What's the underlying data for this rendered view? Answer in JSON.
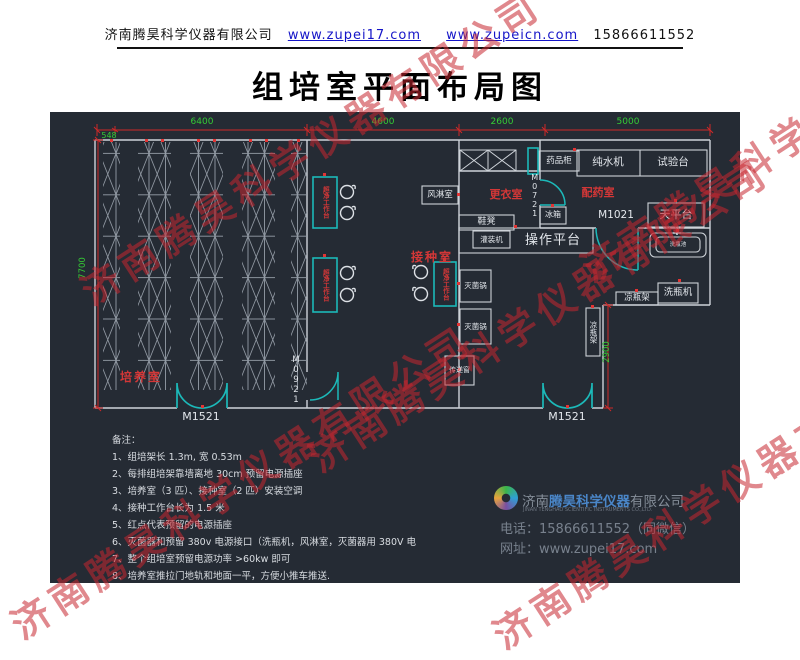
{
  "header": {
    "company": "济南腾昊科学仪器有限公司",
    "url1": "www.zupei17.com",
    "url2": "www.zupeicn.com",
    "phone": "15866611552"
  },
  "title": "组培室平面布局图",
  "watermark": {
    "text": "济南腾昊科学仪器有限公司"
  },
  "plan": {
    "dims": {
      "d548": "548",
      "d6400": "6400",
      "d4600": "4600",
      "d2600": "2600",
      "d5000": "5000",
      "d7700": "7700",
      "d2900": "2900"
    },
    "rooms": {
      "culture": "培养室",
      "inoculation": "接种室",
      "changing": "更衣室",
      "dispensing": "配药室"
    },
    "doors": {
      "m1521": "M1521",
      "m0921": "M0921",
      "m0721": "M0721",
      "m1021": "M1021"
    },
    "fixtures": {
      "air_shower": "风淋室",
      "medicine_cabinet": "药品柜",
      "water_purifier": "纯水机",
      "test_bench": "试验台",
      "fridge": "冰箱",
      "balance_table": "天平台",
      "sink": "洗瓶池",
      "shoe_bench": "鞋凳",
      "filling_machine": "灌装机",
      "operation_platform": "操作平台",
      "sterilizer": "灭菌锅",
      "transfer_window": "传递窗",
      "bottle_cool_rack": "凉瓶架",
      "bottle_washer": "洗瓶机",
      "clean_bench": "超净工作台"
    }
  },
  "notes": {
    "title": "备注：",
    "items": [
      "1、组培架长 1.3m, 宽 0.53m",
      "2、每排组培架靠墙离地 30cm 预留电源插座",
      "3、培养室（3 匹）、接种室（2 匹）安装空调",
      "4、接种工作台长为 1.5 米",
      "5、红点代表预留的电源插座",
      "6、灭菌器和预留 380v 电源接口（洗瓶机，风淋室，灭菌器用 380V 电",
      "7、整个组培室预留电源功率 >60kw 即可",
      "8、培养室推拉门地轨和地面一平，方便小推车推送."
    ]
  },
  "footer": {
    "name_pre": "济南",
    "name_mid": "腾昊科学仪器",
    "name_suf": "有限公司",
    "name_en": "JINAN TENGHAO SCIENTIFIC INSTRUMENTS CO.,LTD.",
    "phone": "电话：15866611552（同微信）",
    "web": "网址：www.zupei17.com"
  }
}
